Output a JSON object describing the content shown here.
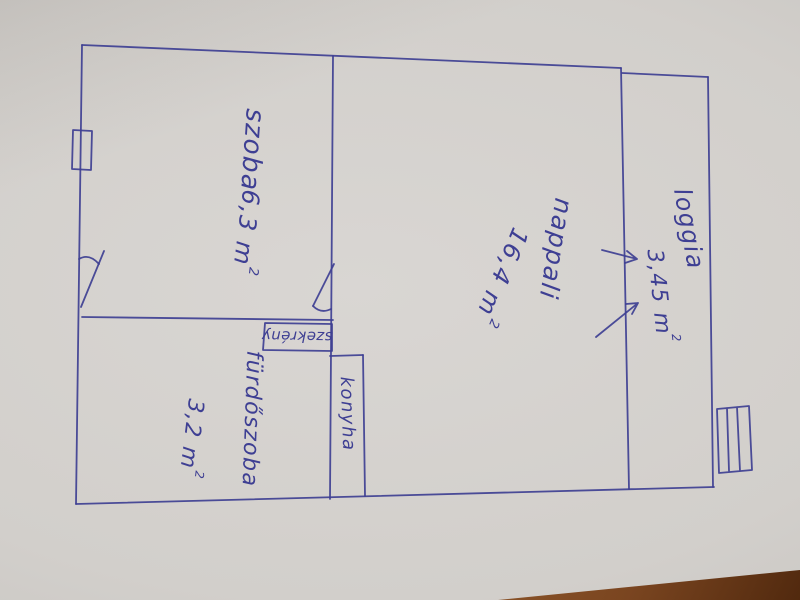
{
  "drawing_type": "hand-drawn floor plan sketch (blue pen on paper)",
  "colors": {
    "pen": "#3e3f93",
    "paper": "#d2cfcb",
    "table_surface": "#6b3c1a"
  },
  "rooms": [
    {
      "id": "szoba",
      "label": "szoba",
      "area": "6,3 m",
      "sup": "2"
    },
    {
      "id": "nappali",
      "label": "nappali",
      "area": "16,4 m",
      "sup": "2"
    },
    {
      "id": "loggia",
      "label": "loggia",
      "area": "3,45 m",
      "sup": "2"
    },
    {
      "id": "furdoszoba",
      "label": "fürdőszoba",
      "area": "3,2 m",
      "sup": "2"
    },
    {
      "id": "konyha",
      "label": "konyha"
    },
    {
      "id": "szekreny",
      "label": "szekrény"
    }
  ]
}
